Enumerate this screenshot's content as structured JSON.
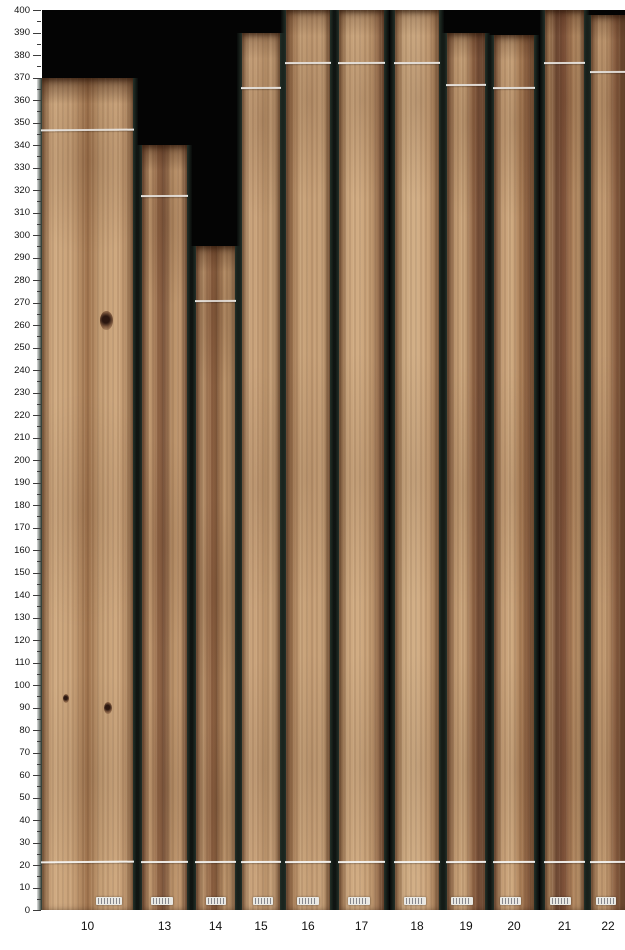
{
  "chart_data": {
    "type": "bar",
    "title": "",
    "xlabel": "",
    "ylabel": "",
    "ylim": [
      0,
      400
    ],
    "y_major_step": 10,
    "y_minor_step": 5,
    "grid": false,
    "legend": "none",
    "categories": [
      "10",
      "13",
      "14",
      "15",
      "16",
      "17",
      "18",
      "19",
      "20",
      "21",
      "22"
    ],
    "values": [
      370,
      340,
      295,
      390,
      400,
      400,
      400,
      390,
      389,
      400,
      398
    ],
    "trim_line_top": [
      347,
      318,
      271,
      366,
      377,
      377,
      377,
      367,
      366,
      377,
      373
    ],
    "trim_line_bottom": [
      22,
      22,
      22,
      22,
      22,
      22,
      22,
      22,
      22,
      22,
      22
    ],
    "axis_tick_labels": [
      "0",
      "10",
      "20",
      "30",
      "40",
      "50",
      "60",
      "70",
      "80",
      "90",
      "100",
      "110",
      "120",
      "130",
      "140",
      "150",
      "160",
      "170",
      "180",
      "190",
      "200",
      "210",
      "220",
      "230",
      "240",
      "250",
      "260",
      "270",
      "280",
      "290",
      "300",
      "310",
      "320",
      "330",
      "340",
      "350",
      "360",
      "370",
      "380",
      "390",
      "400"
    ],
    "colors": {
      "plot_background": "#040404",
      "gap_green": "#233028",
      "trim_line": "#f6f6f4",
      "tick": "#3c3c3c",
      "label_text": "#141414",
      "sticker": "#e9e8e3"
    },
    "boards": [
      {
        "id": "10",
        "x": 42,
        "w": 91,
        "len": 370,
        "line_top": 347,
        "line_bottom": 22,
        "band": 0.85,
        "sticker_x": 74,
        "sticker_w": 26,
        "wood": "#a87e58 0%, #d1ac83 12%, #c8a178 34%, #a0744e 50%, #c49e75 64%, #cfa980 82%, #b28760 100%",
        "knots": [
          {
            "x": 64,
            "y": 28,
            "s": 13
          },
          {
            "x": 23,
            "y": 74,
            "s": 6
          },
          {
            "x": 68,
            "y": 75,
            "s": 8
          }
        ]
      },
      {
        "id": "13",
        "x": 142,
        "w": 45,
        "len": 340,
        "line_top": 318,
        "line_bottom": 22,
        "band": 0.7,
        "sticker_x": 45,
        "sticker_w": 22,
        "wood": "#8a5f43 0%, #c49c73 18%, #8f6344 38%, #7c553c 48%, #b68e66 66%, #c89f76 85%, #9d7252 100%",
        "knots": []
      },
      {
        "id": "14",
        "x": 196,
        "w": 39,
        "len": 295,
        "line_top": 271,
        "line_bottom": 22,
        "band": 0.6,
        "sticker_x": 50,
        "sticker_w": 20,
        "wood": "#96684a 0%, #bf9870 16%, #8d6041 42%, #7f5739 52%, #b78f67 70%, #c1996f 100%",
        "knots": []
      },
      {
        "id": "15",
        "x": 242,
        "w": 38,
        "len": 390,
        "line_top": 366,
        "line_bottom": 22,
        "band": 0.45,
        "sticker_x": 55,
        "sticker_w": 20,
        "wood": "#a97f5b 0%, #cfa981 15%, #c7a078 45%, #b9926a 62%, #cca67e 82%, #a87d58 100%",
        "knots": []
      },
      {
        "id": "16",
        "x": 286,
        "w": 44,
        "len": 400,
        "line_top": 377,
        "line_bottom": 22,
        "band": 0.5,
        "sticker_x": 50,
        "sticker_w": 22,
        "wood": "#8f6547 0%, #a57a54 12%, #cba67d 35%, #c49d75 60%, #cda77e 85%, #9f7450 100%",
        "knots": []
      },
      {
        "id": "17",
        "x": 339,
        "w": 45,
        "len": 400,
        "line_top": 377,
        "line_bottom": 22,
        "band": 0.45,
        "sticker_x": 45,
        "sticker_w": 22,
        "wood": "#a07550 0%, #cca77e 18%, #d2ad84 45%, #c29b72 70%, #8e6245 100%",
        "knots": []
      },
      {
        "id": "18",
        "x": 395,
        "w": 44,
        "len": 400,
        "line_top": 377,
        "line_bottom": 22,
        "band": 0.4,
        "sticker_x": 45,
        "sticker_w": 22,
        "wood": "#a87d57 0%, #ceab82 20%, #d3b088 50%, #c9a279 75%, #a97e58 100%",
        "knots": []
      },
      {
        "id": "19",
        "x": 447,
        "w": 38,
        "len": 390,
        "line_top": 367,
        "line_bottom": 22,
        "band": 0.5,
        "sticker_x": 40,
        "sticker_w": 22,
        "wood": "#8a5f42 0%, #c39c73 22%, #cba67d 45%, #8b5f41 72%, #77503a 84%, #9b7050 100%",
        "knots": []
      },
      {
        "id": "20",
        "x": 494,
        "w": 40,
        "len": 389,
        "line_top": 366,
        "line_bottom": 22,
        "band": 0.5,
        "sticker_x": 40,
        "sticker_w": 21,
        "wood": "#8e6346 0%, #c7a077 20%, #cfaa81 45%, #a87c55 68%, #8a5e41 88%, #a1754f 100%",
        "knots": []
      },
      {
        "id": "21",
        "x": 545,
        "w": 39,
        "len": 400,
        "line_top": 377,
        "line_bottom": 22,
        "band": 0.55,
        "sticker_x": 40,
        "sticker_w": 21,
        "wood": "#9a6f4c 0%, #b78e66 12%, #6f4a35 30%, #7d5038 48%, #a97e58 68%, #c1996f 88%, #9c7150 100%",
        "knots": []
      },
      {
        "id": "22",
        "x": 591,
        "w": 34,
        "len": 398,
        "line_top": 373,
        "line_bottom": 22,
        "band": 0.5,
        "sticker_x": 45,
        "sticker_w": 20,
        "wood": "#9d7250 0%, #c49d74 22%, #bc946c 48%, #8c6043 72%, #7d5539 88%, #946847 100%",
        "knots": []
      }
    ],
    "layout": {
      "plot_left": 42,
      "plot_top": 10,
      "plot_right": 625,
      "plot_bottom": 910,
      "px_per_unit": 2.25
    }
  }
}
